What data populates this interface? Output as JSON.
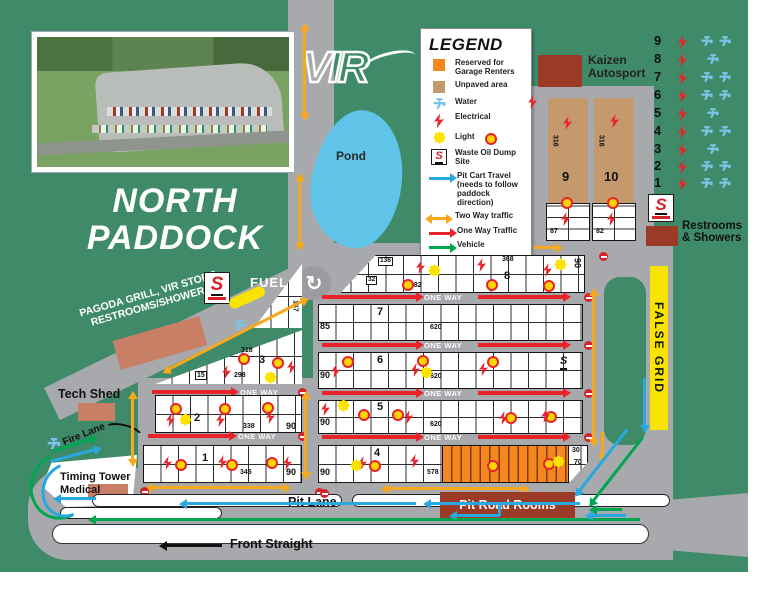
{
  "title": {
    "line1": "NORTH",
    "line2": "PADDOCK"
  },
  "logo": {
    "text": "VIR"
  },
  "icons": {
    "s": "S",
    "roundabout": "↻"
  },
  "colors": {
    "map_green": "#3e8a69",
    "road_gray": "#a7a9ac",
    "reserved_orange": "#f6871f",
    "unpaved_tan": "#c49a6c",
    "building_red": "#9c3a28",
    "building_salmon": "#c97f66",
    "pond_blue": "#5fc4e8",
    "two_way_yellow": "#f7a81c",
    "one_way_red": "#e8232a",
    "pit_cart_blue": "#29a8e0",
    "vehicle_green": "#00a551",
    "light_yellow": "#ffd400",
    "false_grid_yellow": "#f9e400"
  },
  "legend": {
    "title": "LEGEND",
    "items": [
      {
        "icon": "reserved-swatch",
        "label": "Reserved for Garage Renters"
      },
      {
        "icon": "unpaved-swatch",
        "label": "Unpaved area"
      },
      {
        "icon": "water-icon",
        "label": "Water"
      },
      {
        "icon": "electrical-icon",
        "label": "Electrical"
      },
      {
        "icon": "light-icon",
        "label": "Light"
      },
      {
        "icon": "waste-oil-icon",
        "label": "Waste Oil Dump Site"
      },
      {
        "icon": "pit-cart-arrow",
        "label": "Pit Cart Travel (needs to follow paddock direction)"
      },
      {
        "icon": "two-way-arrow",
        "label": "Two Way traffic"
      },
      {
        "icon": "one-way-arrow",
        "label": "One Way Traffic"
      },
      {
        "icon": "vehicle-arrow",
        "label": "Vehicle"
      }
    ]
  },
  "labels": {
    "pond": "Pond",
    "kaizen": "Kaizen Autosport",
    "restrooms": "Restrooms & Showers",
    "fuel": "FUEL",
    "pagoda1": "PAGODA GRILL, VIR STORE",
    "pagoda2": "RESTROOMS/SHOWERS",
    "tech_shed": "Tech Shed",
    "fire_lane": "Fire Lane",
    "timing_tower": "Timing Tower",
    "medical": "Medical",
    "pit_lane": "Pit Lane",
    "pit_road_rooms": "Pit Road Rooms",
    "front_straight": "Front Straight",
    "false_grid": "FALSE GRID",
    "one_way": "ONE WAY"
  },
  "utilities": {
    "rows": [
      "9",
      "8",
      "7",
      "6",
      "5",
      "4",
      "3",
      "2",
      "1"
    ]
  },
  "strips": {
    "s9": {
      "num": "9",
      "size": "316",
      "lot": "87"
    },
    "s10": {
      "num": "10",
      "size": "316",
      "lot": "82"
    }
  },
  "grid": {
    "row8": {
      "num": "8",
      "c136": "136",
      "c32": "32",
      "c482": "482",
      "c368": "368",
      "right": "90"
    },
    "row7": {
      "num": "7",
      "left": "85",
      "mid": "620"
    },
    "row6": {
      "num": "6",
      "left": "90",
      "mid": "620"
    },
    "row5": {
      "num": "5",
      "left": "90",
      "mid": "620"
    },
    "row4": {
      "num": "4",
      "left": "90",
      "mid": "578",
      "r30": "30",
      "r70": "70"
    },
    "row3": {
      "num": "3",
      "c318": "318",
      "c15": "15",
      "c298": "298",
      "c167": "167"
    },
    "row2": {
      "num": "2",
      "mid": "338",
      "right": "90"
    },
    "row1": {
      "num": "1",
      "mid": "345",
      "right": "90"
    }
  }
}
